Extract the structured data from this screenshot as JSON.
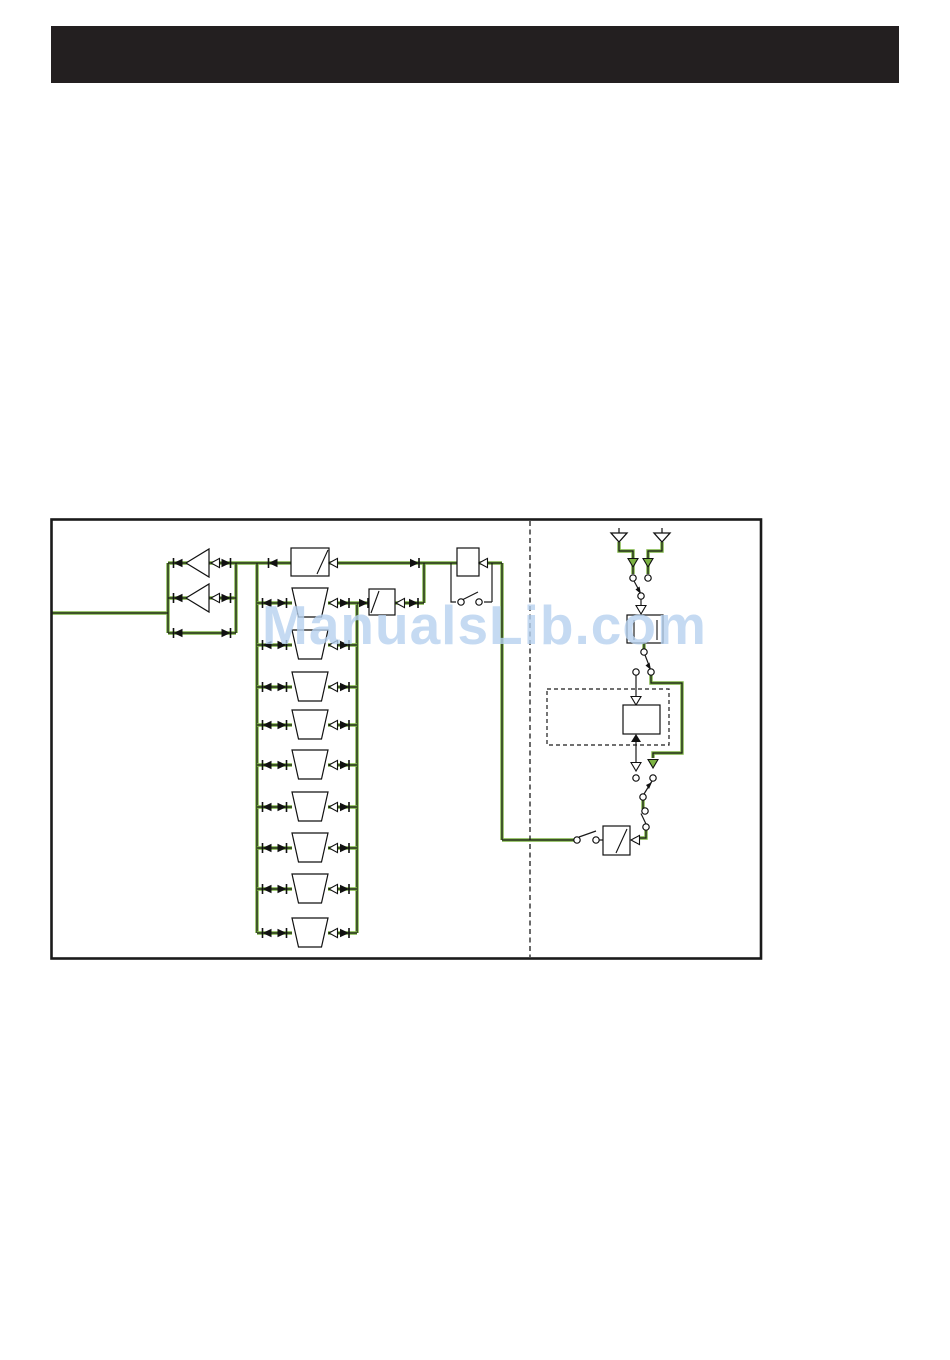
{
  "page": {
    "background_color": "#ffffff"
  },
  "header_bar": {
    "color": "#231f20"
  },
  "watermark": {
    "text": "ManualsLib.com",
    "color": "#b7d2f0"
  },
  "diagram": {
    "border_color": "#1a1a1a",
    "wire_color": "#1a1a1a",
    "highlight_color": "#7cb342",
    "bandpass_filter_rows": 9,
    "amplifier_count": 2,
    "antenna_count": 2
  }
}
